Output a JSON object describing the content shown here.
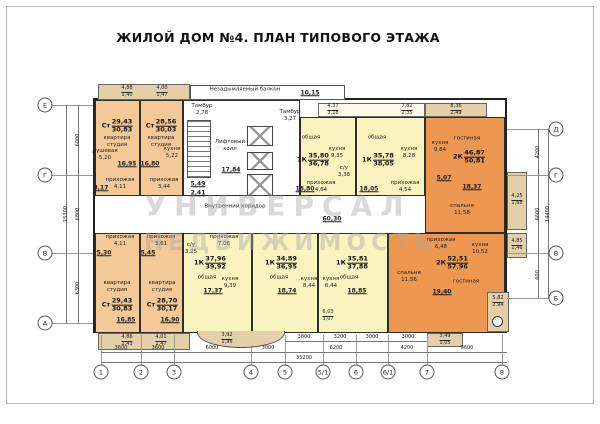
{
  "title": "ЖИЛОЙ ДОМ №4. ПЛАН ТИПОВОГО ЭТАЖА",
  "watermark": {
    "line1": "УНИВЕРСАЛ",
    "line2": "НЕДВИЖИМОСТЬ"
  },
  "axes": {
    "left": [
      "Е",
      "Г",
      "В",
      "А"
    ],
    "right": [
      "Д",
      "Г",
      "В",
      "Б"
    ],
    "bottom": [
      "1",
      "2",
      "3",
      "4",
      "5",
      "5/1",
      "6",
      "6/1",
      "7",
      "8"
    ]
  },
  "dims": {
    "row1": [
      "3800",
      "3200",
      "3000",
      "3000"
    ],
    "row2": [
      "3600",
      "3600",
      "6000",
      "3000",
      "6200",
      "4200",
      "9600"
    ],
    "total": "35200",
    "left": [
      "6000",
      "6800",
      "6300"
    ],
    "left_total": "15300",
    "right": [
      "4200",
      "6600",
      "600"
    ],
    "right_total": "14400"
  },
  "core": {
    "smoke_label": "Незадымляемый балкон",
    "smoke_area": "10,15",
    "tambour1": "Тамбур\n2,78",
    "tambour2": "Тамбур\n3,27",
    "lift_label": "Лифтовый\nхолл",
    "lift_area": "17,84",
    "stairs_area": "5,49",
    "vest_area": "2,41"
  },
  "corridor": {
    "label": "Внутренний коридор",
    "area": "60,30"
  },
  "apts": {
    "t1": {
      "type": "Ст",
      "a1": "29,43",
      "a2": "30,83",
      "name": "квартира\nстудия",
      "main": "16,95",
      "r1": "душевая\n5,20",
      "r2": "прихожая\n4,11",
      "r3": "3,17"
    },
    "t2": {
      "type": "Ст",
      "a1": "28,56",
      "a2": "30,03",
      "name": "квартира\nстудия",
      "main": "16,80",
      "r1": "кухня\n5,22",
      "r2": "прихожая\n3,44"
    },
    "t3": {
      "type": "1К",
      "a1": "35,80",
      "a2": "36,78",
      "name": "общая",
      "main": "18,80",
      "r1": "кухня\n9,35",
      "r2": "прихожая\n4,64",
      "r3": "с/у\n3,38"
    },
    "t4": {
      "type": "1К",
      "a1": "35,78",
      "a2": "38,05",
      "name": "общая",
      "main": "18,05",
      "r1": "кухня\n8,28",
      "r2": "прихожая\n4,54"
    },
    "t5": {
      "type": "2К",
      "a1": "46,87",
      "a2": "50,81",
      "name": "гостиная",
      "main": "18,37",
      "r1": "кухня\n9,84",
      "r2": "спальня\n11,58",
      "r3": "5,07"
    },
    "b1": {
      "type": "Ст",
      "a1": "29,43",
      "a2": "30,83",
      "name": "квартира\nстудия",
      "main": "16,85",
      "r1": "прихожая\n4,11",
      "r2": "5,30"
    },
    "b2": {
      "type": "Ст",
      "a1": "28,70",
      "a2": "30,17",
      "name": "квартира\nстудия",
      "main": "16,90",
      "r1": "прихожая\n3,61",
      "r2": "5,45"
    },
    "b3": {
      "type": "1К",
      "a1": "37,96",
      "a2": "39,92",
      "name": "общая",
      "main": "17,37",
      "r1": "кухня\n9,39",
      "r2": "прихожая\n7,06",
      "r3": "с/у\n3,25"
    },
    "b4": {
      "type": "1К",
      "a1": "34,89",
      "a2": "36,95",
      "name": "общая",
      "main": "18,74",
      "r1": "кухня\n8,44"
    },
    "b5": {
      "type": "1К",
      "a1": "35,81",
      "a2": "37,88",
      "name": "общая",
      "main": "18,85",
      "r1": "кухня\n6,44"
    },
    "b6": {
      "type": "2К",
      "a1": "52,51",
      "a2": "57,96",
      "name": "гостиная",
      "main": "19,40",
      "r1": "кухня\n10,52",
      "r2": "спальня\n11,56",
      "r3": "прихожая\n6,48"
    }
  },
  "balconies": {
    "tl1": {
      "t": "4,88",
      "b": "1,40"
    },
    "tl2": {
      "t": "4,00",
      "b": "1,47"
    },
    "tm1": {
      "t": "4,37",
      "b": "3,18"
    },
    "tm2": {
      "t": "7,82",
      "b": "2,35"
    },
    "tr": {
      "t": "8,36",
      "b": "2,49"
    },
    "r1": {
      "t": "4,25",
      "b": "1,68"
    },
    "r2": {
      "t": "4,85",
      "b": "1,46"
    },
    "bl1": {
      "t": "4,86",
      "b": "1,43"
    },
    "bl2": {
      "t": "4,01",
      "b": "1,47"
    },
    "bay": {
      "t": "3,92",
      "b": "1,96"
    },
    "b5l": {
      "t": "6,03",
      "b": "3,07"
    },
    "br": {
      "t": "3,49",
      "b": "1,05"
    },
    "corner": {
      "t": "5,82",
      "b": "2,94"
    }
  }
}
